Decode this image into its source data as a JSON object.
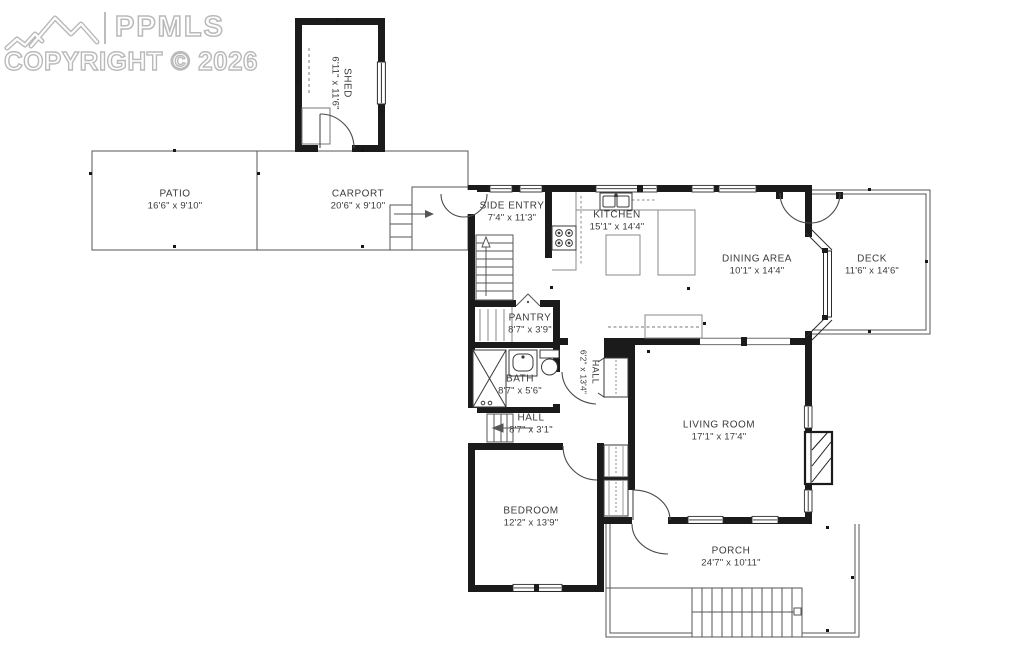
{
  "watermark": {
    "brand": "PPMLS",
    "copyright": "COPYRIGHT © 2026"
  },
  "rooms": {
    "shed": {
      "name": "SHED",
      "dims": "6'11\" x 11'6\""
    },
    "patio": {
      "name": "PATIO",
      "dims": "16'6\" x 9'10\""
    },
    "carport": {
      "name": "CARPORT",
      "dims": "20'6\" x 9'10\""
    },
    "side_entry": {
      "name": "SIDE ENTRY",
      "dims": "7'4\" x 11'3\""
    },
    "kitchen": {
      "name": "KITCHEN",
      "dims": "15'1\" x 14'4\""
    },
    "dining": {
      "name": "DINING AREA",
      "dims": "10'1\" x 14'4\""
    },
    "deck": {
      "name": "DECK",
      "dims": "11'6\" x 14'6\""
    },
    "pantry": {
      "name": "PANTRY",
      "dims": "8'7\" x 3'9\""
    },
    "bath": {
      "name": "BATH",
      "dims": "8'7\" x 5'6\""
    },
    "hall_upper": {
      "name": "HALL",
      "dims": "6'2\" x 13'4\""
    },
    "hall_lower": {
      "name": "HALL",
      "dims": "8'7\" x 3'1\""
    },
    "living": {
      "name": "LIVING ROOM",
      "dims": "17'1\" x 17'4\""
    },
    "bedroom": {
      "name": "BEDROOM",
      "dims": "12'2\" x 13'9\""
    },
    "porch": {
      "name": "PORCH",
      "dims": "24'7\" x 10'11\""
    }
  }
}
